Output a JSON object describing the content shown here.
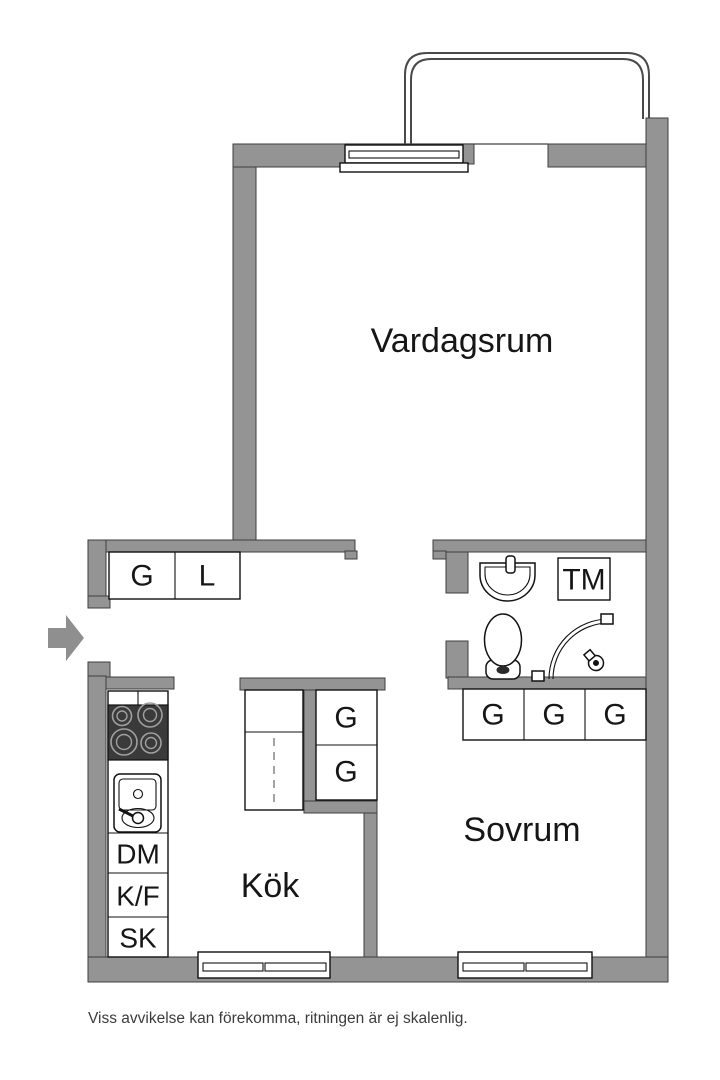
{
  "floorplan": {
    "rooms": {
      "living_room": "Vardagsrum",
      "kitchen": "Kök",
      "bedroom": "Sovrum"
    },
    "labels": {
      "hall_wardrobe": "G",
      "hall_linen_closet": "L",
      "washing_machine": "TM",
      "corridor_wardrobe_top": "G",
      "corridor_wardrobe_bottom": "G",
      "bedroom_wardrobe_1": "G",
      "bedroom_wardrobe_2": "G",
      "bedroom_wardrobe_3": "G",
      "dishwasher": "DM",
      "fridge_freezer": "K/F",
      "cleaning_cupboard": "SK"
    },
    "disclaimer": "Viss avvikelse kan förekomma, ritningen är ej skalenlig.",
    "colors": {
      "wall": "#949494",
      "outline": "#111111",
      "stove": "#3a3a3a",
      "background": "#ffffff"
    }
  }
}
